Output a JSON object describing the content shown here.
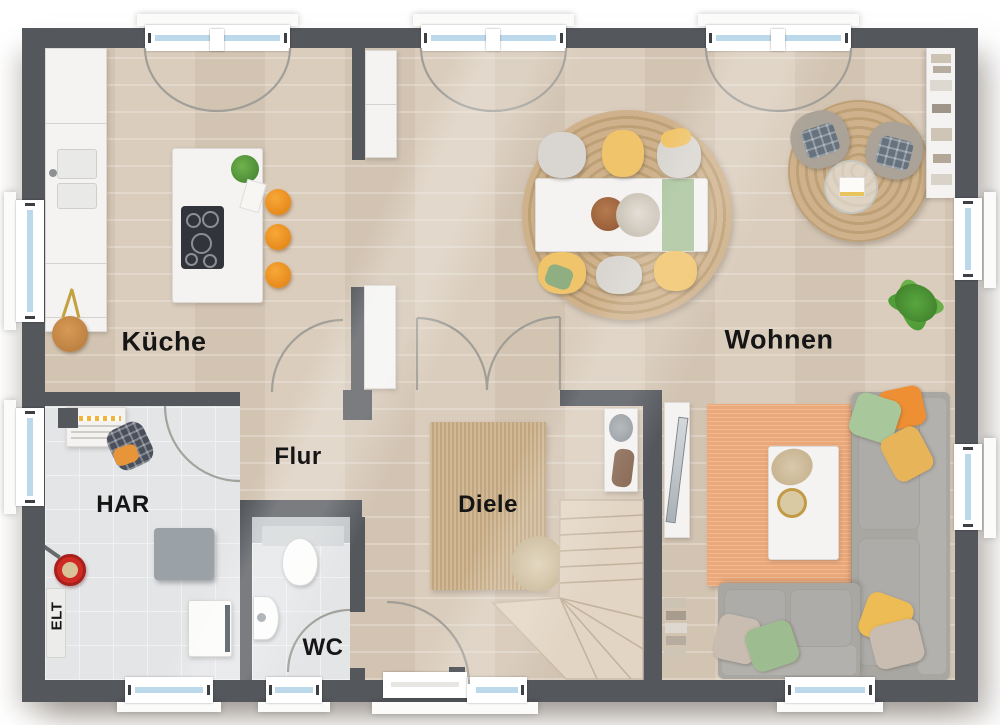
{
  "plan": {
    "rooms": [
      {
        "id": "kueche",
        "label": "Küche"
      },
      {
        "id": "wohnen",
        "label": "Wohnen"
      },
      {
        "id": "flur",
        "label": "Flur"
      },
      {
        "id": "diele",
        "label": "Diele"
      },
      {
        "id": "har",
        "label": "HAR"
      },
      {
        "id": "wc",
        "label": "WC"
      },
      {
        "id": "elt",
        "label": "ELT"
      }
    ]
  },
  "colors": {
    "wall": "#54575c",
    "floor-wood": "#d8cab9",
    "tile": "#e4e5e7",
    "rug-jute": "#c9ad85",
    "rug-orange": "#eba878",
    "glass": "#bcd9ec",
    "frame": "#ffffff",
    "accent-orange": "#f29222",
    "chair-yellow": "#f0c46a",
    "green": "#a6c298",
    "sofa-grey": "#a9a7a2",
    "stair-wood": "#e2d5c3",
    "swing-stroke": "#9b9a94",
    "label": "#151515"
  }
}
